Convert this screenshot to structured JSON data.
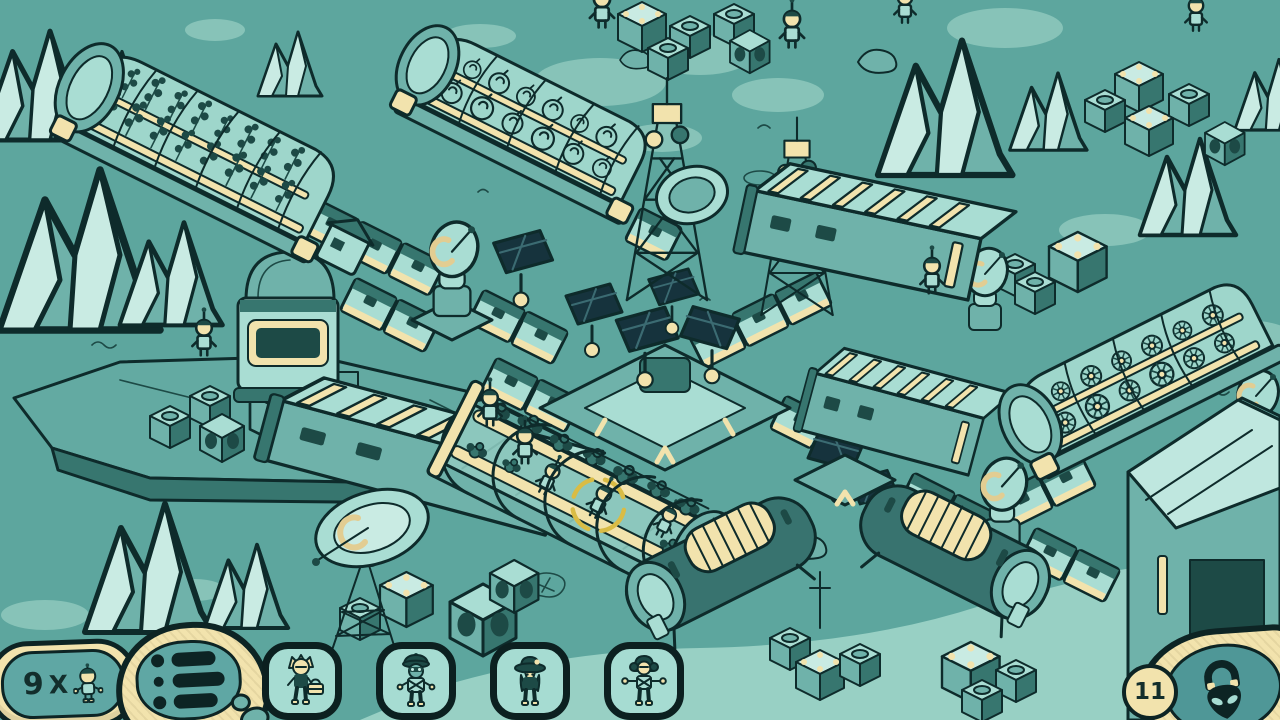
{
  "title": "Isometric moon base colony game",
  "hud": {
    "crew_counter": {
      "count": "9",
      "multiplier": "X",
      "icon": "astronaut-icon"
    },
    "menu": {
      "icon": "list-menu-icon"
    },
    "crew_portraits": [
      {
        "id": "crew-1",
        "icon": "crew-blond-toolbox-portrait"
      },
      {
        "id": "crew-2",
        "icon": "crew-cap-portrait"
      },
      {
        "id": "crew-3",
        "icon": "crew-wide-hat-portrait"
      },
      {
        "id": "crew-4",
        "icon": "crew-headphones-portrait"
      }
    ],
    "lock_badge": {
      "count": "11",
      "icon": "alien-padlock-icon"
    }
  },
  "scene": {
    "setting": "isometric moon base on teal rocky terrain",
    "elements": [
      "greenhouse with vine crops",
      "greenhouse with round crops",
      "greenhouse with flowers",
      "open greenhouse with crew and selection ring",
      "central hub with solar panels",
      "lattice radio towers",
      "satellite dishes",
      "command module",
      "louvered warehouses",
      "cylindrical tanks",
      "storage crates",
      "rock plateau",
      "mountains",
      "walking colonists"
    ]
  },
  "colors": {
    "ground": "#5da69e",
    "ground_light": "#87c3b8",
    "outline": "#0e2b2b",
    "cream": "#f2e3ad",
    "panel_light": "#a9ddd3",
    "building_dark": "#38736f",
    "solar_panel": "#16333d",
    "selection_ring": "#d9bc45",
    "hud_button_fill": "#a6dcd2",
    "hud_oval": "#5fa7a4"
  }
}
